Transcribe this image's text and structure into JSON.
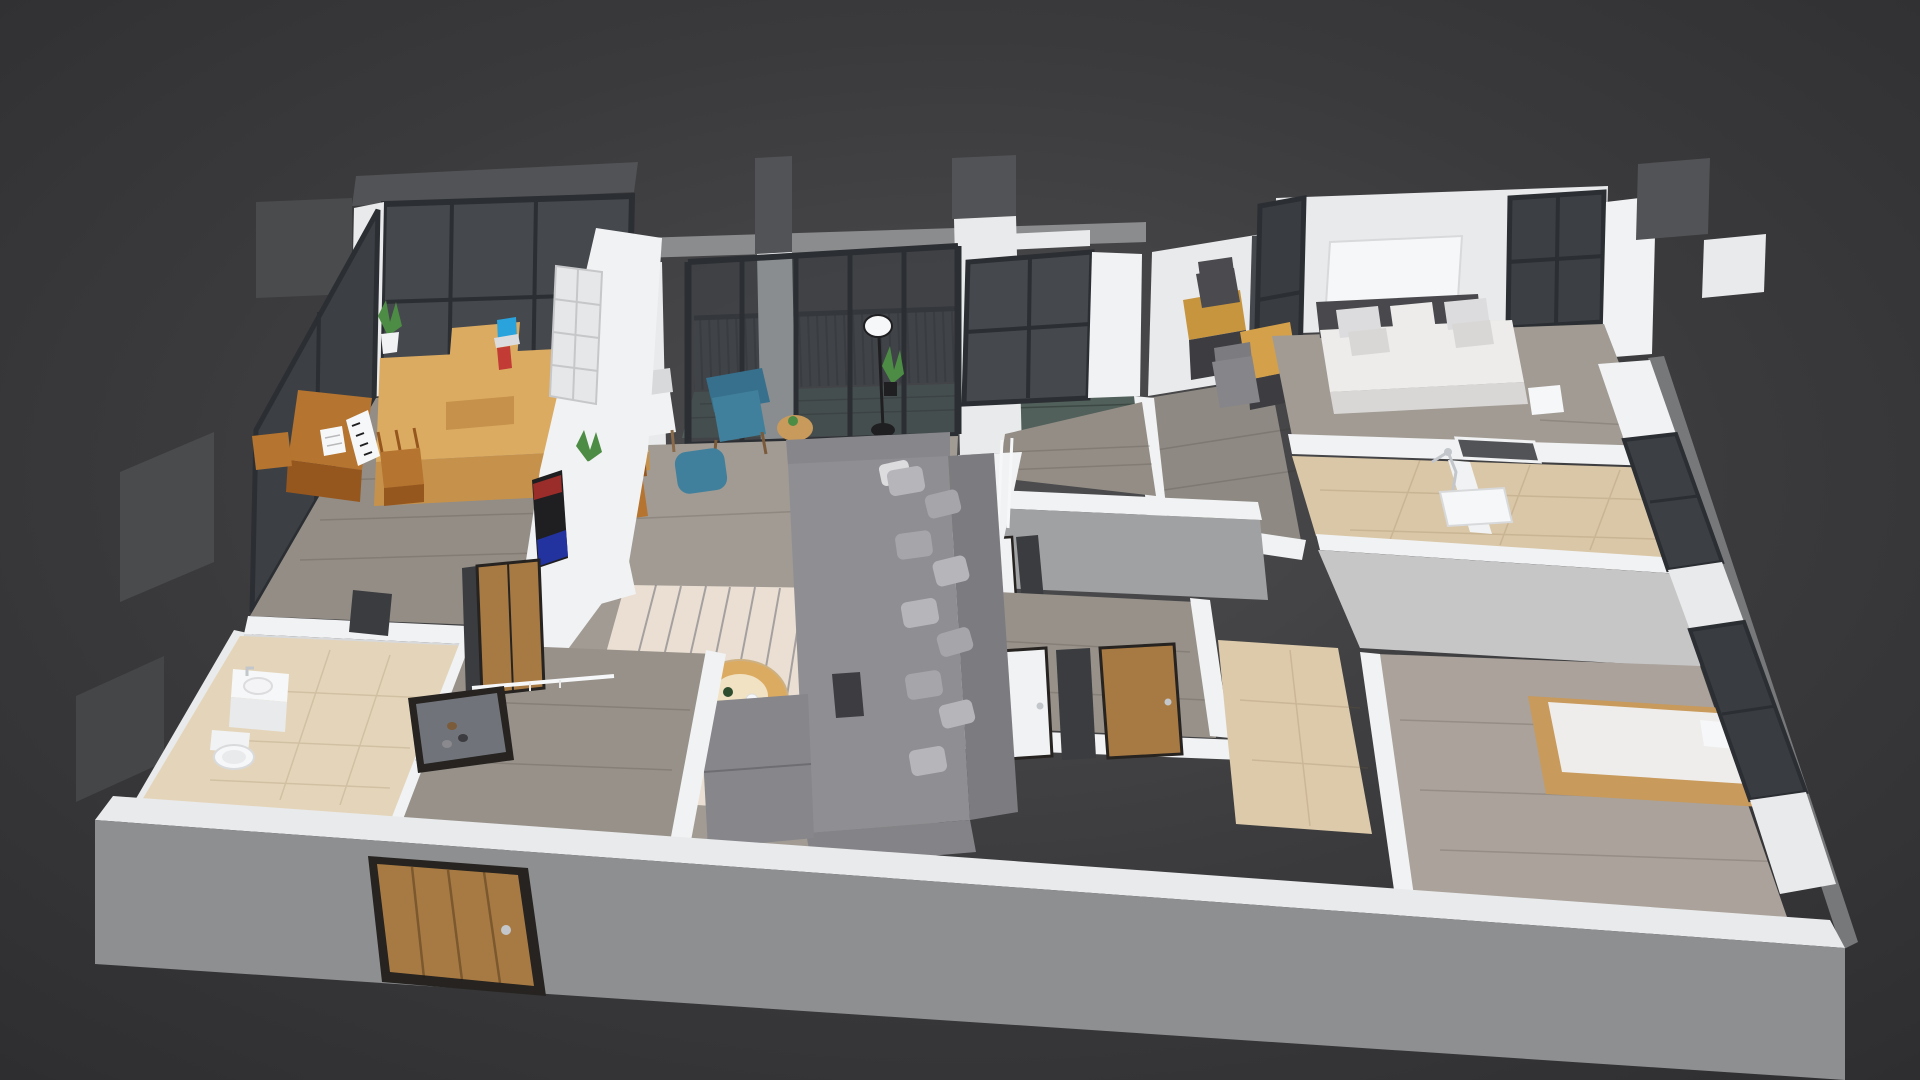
{
  "scene": {
    "title": "3D cutaway dollhouse render of an apartment floor plan on a dark gray backdrop",
    "projection": "steep axonometric view from front-above",
    "rooms": [
      {
        "name": "study-piano-room",
        "floor": "gray wood planks",
        "items": [
          "floor-to-ceiling corner windows",
          "window bench cabinet",
          "writing desk",
          "laptop",
          "red book",
          "potted plant",
          "upright piano with sheet music",
          "wooden stool",
          "small side stool"
        ]
      },
      {
        "name": "bathroom-left",
        "floor": "beige tile",
        "items": [
          "vanity sink",
          "toilet",
          "dark doorway"
        ]
      },
      {
        "name": "entry-hall",
        "floor": "gray wood planks",
        "items": [
          "wood entry door in front wall",
          "wardrobe sliding wood door",
          "leaning mirror shoe cabinet",
          "shoes",
          "white coat rail"
        ]
      },
      {
        "name": "living-dining-room",
        "floor": "gray wood planks",
        "items": [
          "white bookshelf TV partition",
          "TV screen with red and blue glow",
          "white media console",
          "potted plant",
          "gray sectional sofa",
          "throw pillows",
          "chaise",
          "striped cream rug",
          "round wood coffee table",
          "bottle and cup",
          "teal wingback armchair",
          "teal ottoman",
          "rattan side table",
          "light wood dining table",
          "white chair",
          "brown wood chair",
          "black floor lamp",
          "ladder shelf",
          "shoe bench",
          "dark side table",
          "tall potted plant"
        ]
      },
      {
        "name": "balcony",
        "floor": "dark composite deck",
        "items": [
          "glass balustrade with balusters",
          "handrail",
          "gray overhead beam",
          "sliding glass door wall",
          "white piers"
        ]
      },
      {
        "name": "kitchen",
        "floor": "gray wood planks",
        "items": [
          "black framed window",
          "white appliance column with washer drum"
        ]
      },
      {
        "name": "office-nook",
        "floor": "gray wood planks",
        "items": [
          "two wood desks",
          "dark task chair",
          "gray task chair",
          "interior glass slit window"
        ]
      },
      {
        "name": "master-bedroom",
        "floor": "gray wood planks",
        "items": [
          "double bed with white duvet",
          "six pillows",
          "dark headboard band",
          "white art panel",
          "corner window",
          "white nightstand",
          "pass-through niche"
        ]
      },
      {
        "name": "ensuite-bathroom",
        "floor": "beige tile",
        "items": [
          "chrome shower set",
          "white shower tray",
          "glass divider strip"
        ]
      },
      {
        "name": "hallway",
        "floor": "gray wood planks",
        "items": [
          "white door far",
          "dark doorway gap",
          "white door near",
          "wood door",
          "dark opening"
        ]
      },
      {
        "name": "bathroom-center",
        "floor": "beige tile",
        "items": []
      },
      {
        "name": "bedroom-2",
        "floor": "warm gray wood planks",
        "items": [
          "wood frame bed",
          "white mattress",
          "white pillow",
          "tall back wall",
          "corner windows on right facade"
        ]
      }
    ],
    "exterior": [
      "dark gray fin slabs on left facade",
      "dark parapet slabs top right",
      "gray front wall with wood entry door",
      "white wall top bands"
    ]
  },
  "palette": {
    "bgCenter": "#4e4e50",
    "bgMid": "#3a3a3c",
    "bgEdge": "#2e2e30",
    "wallTop": "#f1f2f3",
    "wallLight": "#e9eaeb",
    "wallShade": "#d8d9db",
    "wallGray": "#a0a1a3",
    "wallWarm": "#c7c6c7",
    "outerGray": "#8e8f91",
    "outerEdge": "#77787a",
    "slabDark": "#525356",
    "slabDark2": "#4a4b4d",
    "slabDark3": "#454648",
    "beamGray": "#8b8c8e",
    "wood": "#a19b94",
    "woodDim": "#938d86",
    "woodCool": "#97918a",
    "woodWarm": "#aaa29b",
    "woodOffice": "#8e8983",
    "deck": "#51605a",
    "beige": "#dccaab",
    "beigeLight": "#e4d5ba",
    "beigeWarm": "#d9c7a7",
    "glass": "#45484d",
    "glassPane": "#3c4045",
    "glassPane2": "#393d42",
    "frame": "#2b2e32",
    "railDark": "#33373b",
    "woodLight": "#dcab62",
    "woodLightFace": "#c6924b",
    "woodMid": "#c8953f",
    "woodMid2": "#d4a049",
    "woodDeep": "#b5742f",
    "woodDeepFace": "#96571f",
    "woodDoor": "#a87a43",
    "doorFrame": "#262320",
    "white": "#f6f7f8",
    "whiteFurn": "#f1f2f3",
    "sofa": "#8f8f93",
    "sofaDark": "#7c7c80",
    "sofaMid": "#86868b",
    "sofaFace": "#848488",
    "pillowA": "#b6b6ba",
    "pillowB": "#a6a6aa",
    "pillowW": "#dcdcde",
    "rug": "#eadfd2",
    "rugStripe": "#6d6d78",
    "teal": "#41809c",
    "tealDark": "#37708c",
    "green": "#4d8c44",
    "chrome": "#c3c7cb",
    "black": "#1f1f21",
    "tvRed": "#b02f2a",
    "tvBlue": "#2336b4",
    "laptopBlue": "#2aa3dc",
    "bookRed": "#c23b35",
    "mirror": "#70747a",
    "opening": "#3a3c3f",
    "grayChair": "#85858a",
    "darkChair": "#4b4b4f",
    "darkFurn": "#3d3d41",
    "bedWhite": "#edecea",
    "bedFace": "#d9d7d5",
    "headboard": "#49494d",
    "mattress2": "#efedeb",
    "bedWood": "#c89a5c"
  }
}
